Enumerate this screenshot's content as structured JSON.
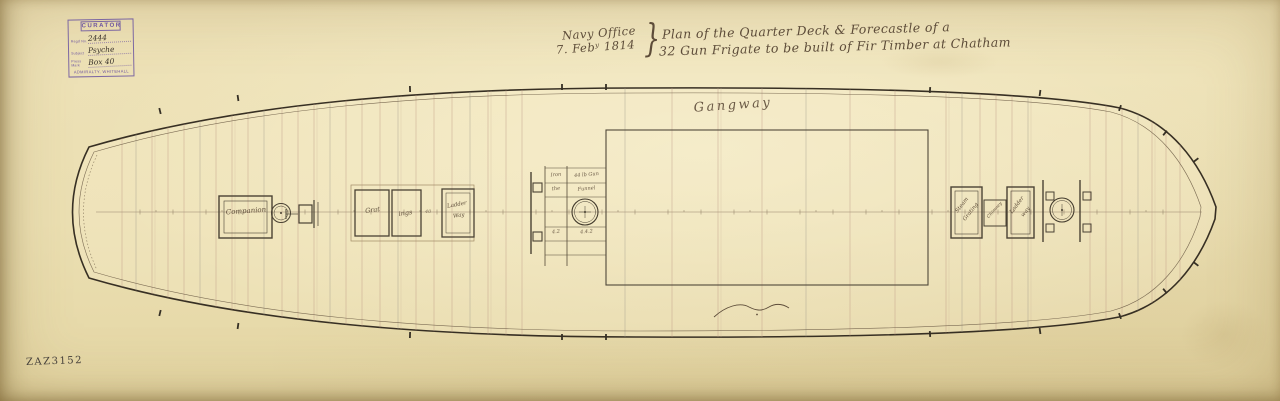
{
  "document": {
    "stamp": {
      "header": "CURATOR",
      "fields": [
        {
          "label": "Regd No.",
          "value": "2444"
        },
        {
          "label": "Subject",
          "value": "Psyche"
        },
        {
          "label": "Press Mark",
          "value": "Box 40"
        }
      ],
      "footer": "ADMIRALTY, WHITEHALL"
    },
    "title": {
      "office": "Navy Office",
      "date": "7. Febʸ 1814",
      "brace": "}",
      "line1": "Plan of the Quarter Deck & Forecastle of a",
      "line2": "32 Gun Frigate to be built of Fir Timber at Chatham"
    },
    "reference": "ZAZ3152"
  },
  "deck": {
    "gangway": "Gangway",
    "companion": "Companion",
    "gratings": {
      "left": "Grat",
      "right": "ings",
      "number": "40"
    },
    "ladderway_aft": {
      "line1": "Ladder",
      "line2": "Way"
    },
    "mid_table": {
      "r1c1": "Iron",
      "r1c2": "44 lb Gun",
      "r2c1": "the",
      "r2c2": "Funnel",
      "r3c1": "4.2",
      "r3c2": "4.4.2"
    },
    "steam_grating": {
      "line1": "Steam",
      "line2": "Grating"
    },
    "chimney": "Chimney",
    "ladderway_fore": {
      "line1": "Ladder",
      "line2": "way"
    }
  },
  "colors": {
    "paper": "#eadfb4",
    "ink": "#372f23",
    "handwriting": "#5d4c39",
    "stamp_purple": "#6f56a0",
    "beam_red": "#bb9684"
  }
}
